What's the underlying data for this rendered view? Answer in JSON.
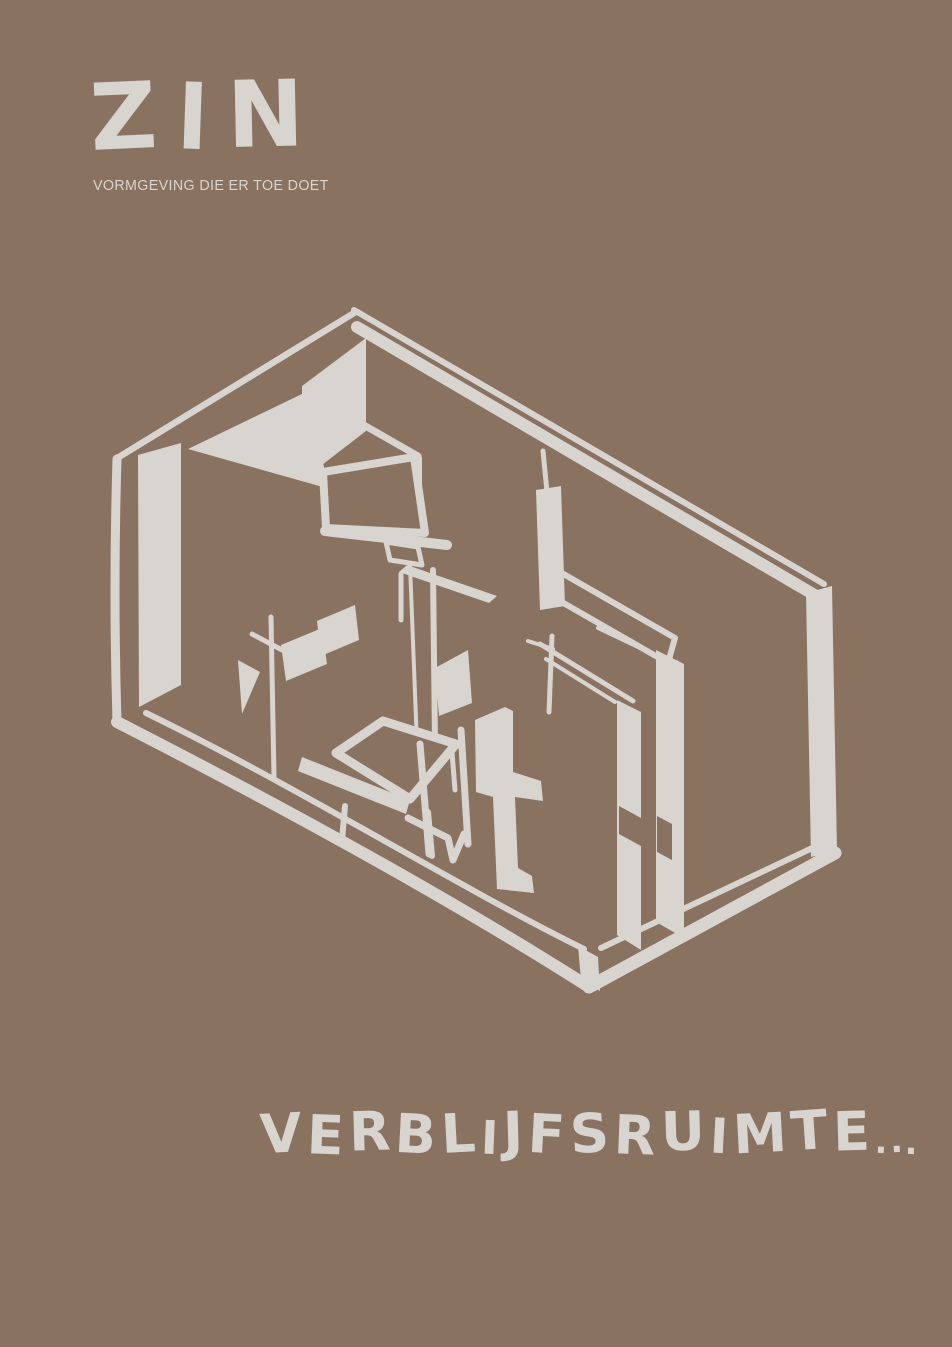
{
  "poster": {
    "background_color": "#8A7261",
    "ink_color": "#D8D4CF",
    "logo": {
      "text": "ZIN",
      "tagline": "VORMGEVING DIE ER TOE DOET"
    },
    "illustration": {
      "label": "Hand-drawn isometric sketch of a room interior with table, chairs, lamp, sideboard, screen and partition walls"
    },
    "title": {
      "text": "VERBLIJFSRUIMTE..."
    }
  }
}
